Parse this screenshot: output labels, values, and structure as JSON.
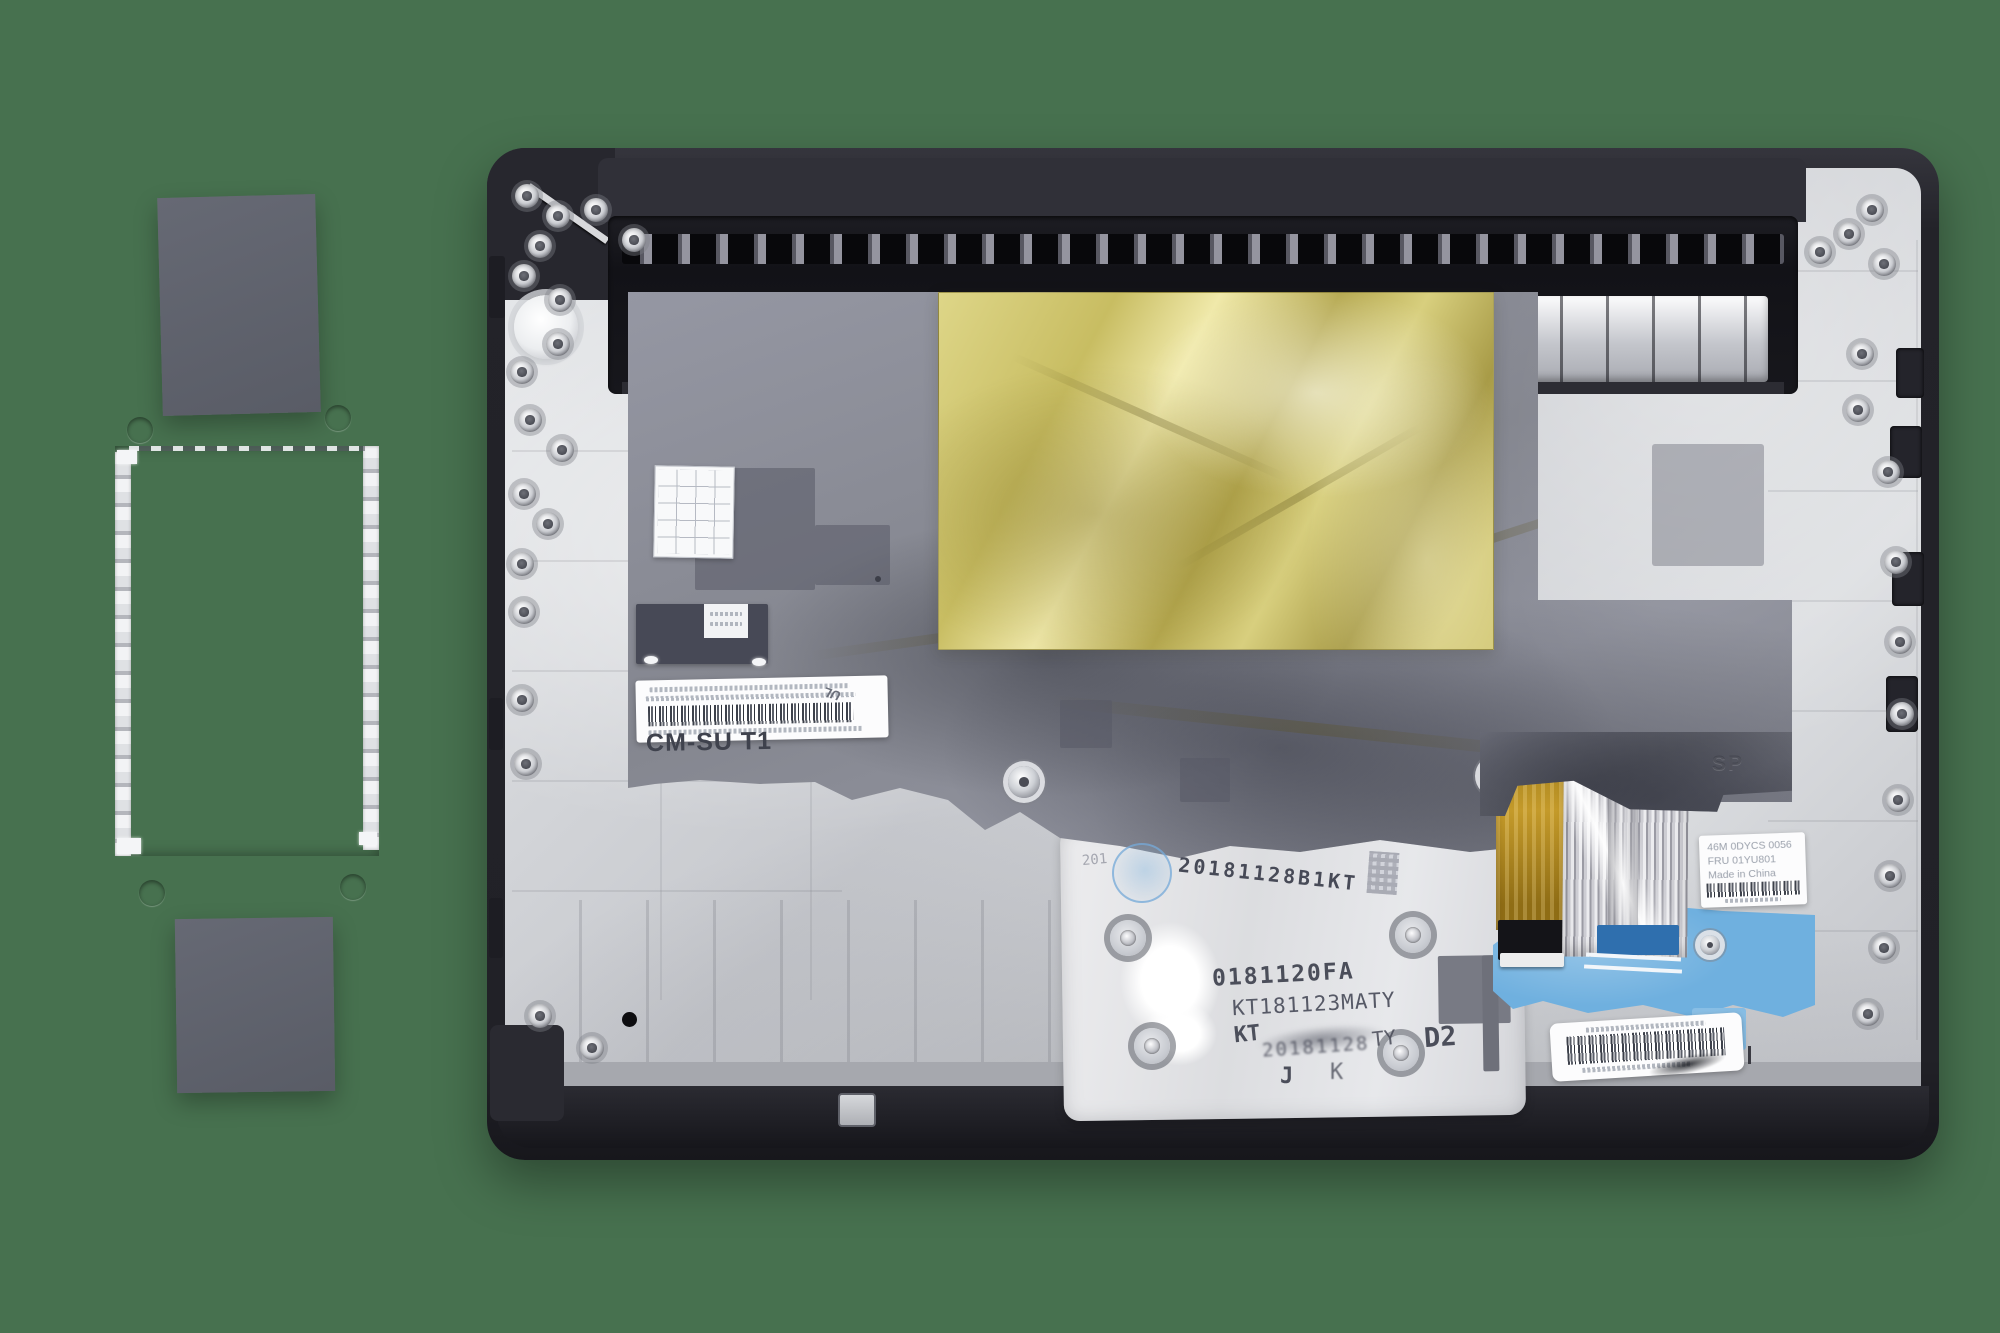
{
  "background": {
    "color": "#47714f"
  },
  "palmrest": {
    "mylar_marking": "CM-SU T1",
    "shield_emboss": "SP",
    "ul_mark": "UL",
    "backplate_stamps": {
      "faint_prefix": "201",
      "date_code": "20181128B1KT",
      "part_code": "0181120FA",
      "kt_code": "KT181123MATY",
      "overstamp_left": "KT",
      "overstamp_smudge": "20181128",
      "overstamp_right": "TY",
      "mark_j": "J",
      "mark_k": "K",
      "position_code": "D2"
    },
    "fru_label": {
      "line1": "46M 0DYCS 0056",
      "line2": "FRU 01YU801",
      "line3": "Made in China"
    }
  },
  "colors": {
    "background_green": "#47714f",
    "chassis_silver": "#d6d8db",
    "frame_charcoal": "#26262c",
    "mylar_gray": "#8a8c98",
    "gold_foil": "#cfc46e",
    "cable_gold": "#b8912a",
    "cable_blue": "#6fb0df"
  }
}
